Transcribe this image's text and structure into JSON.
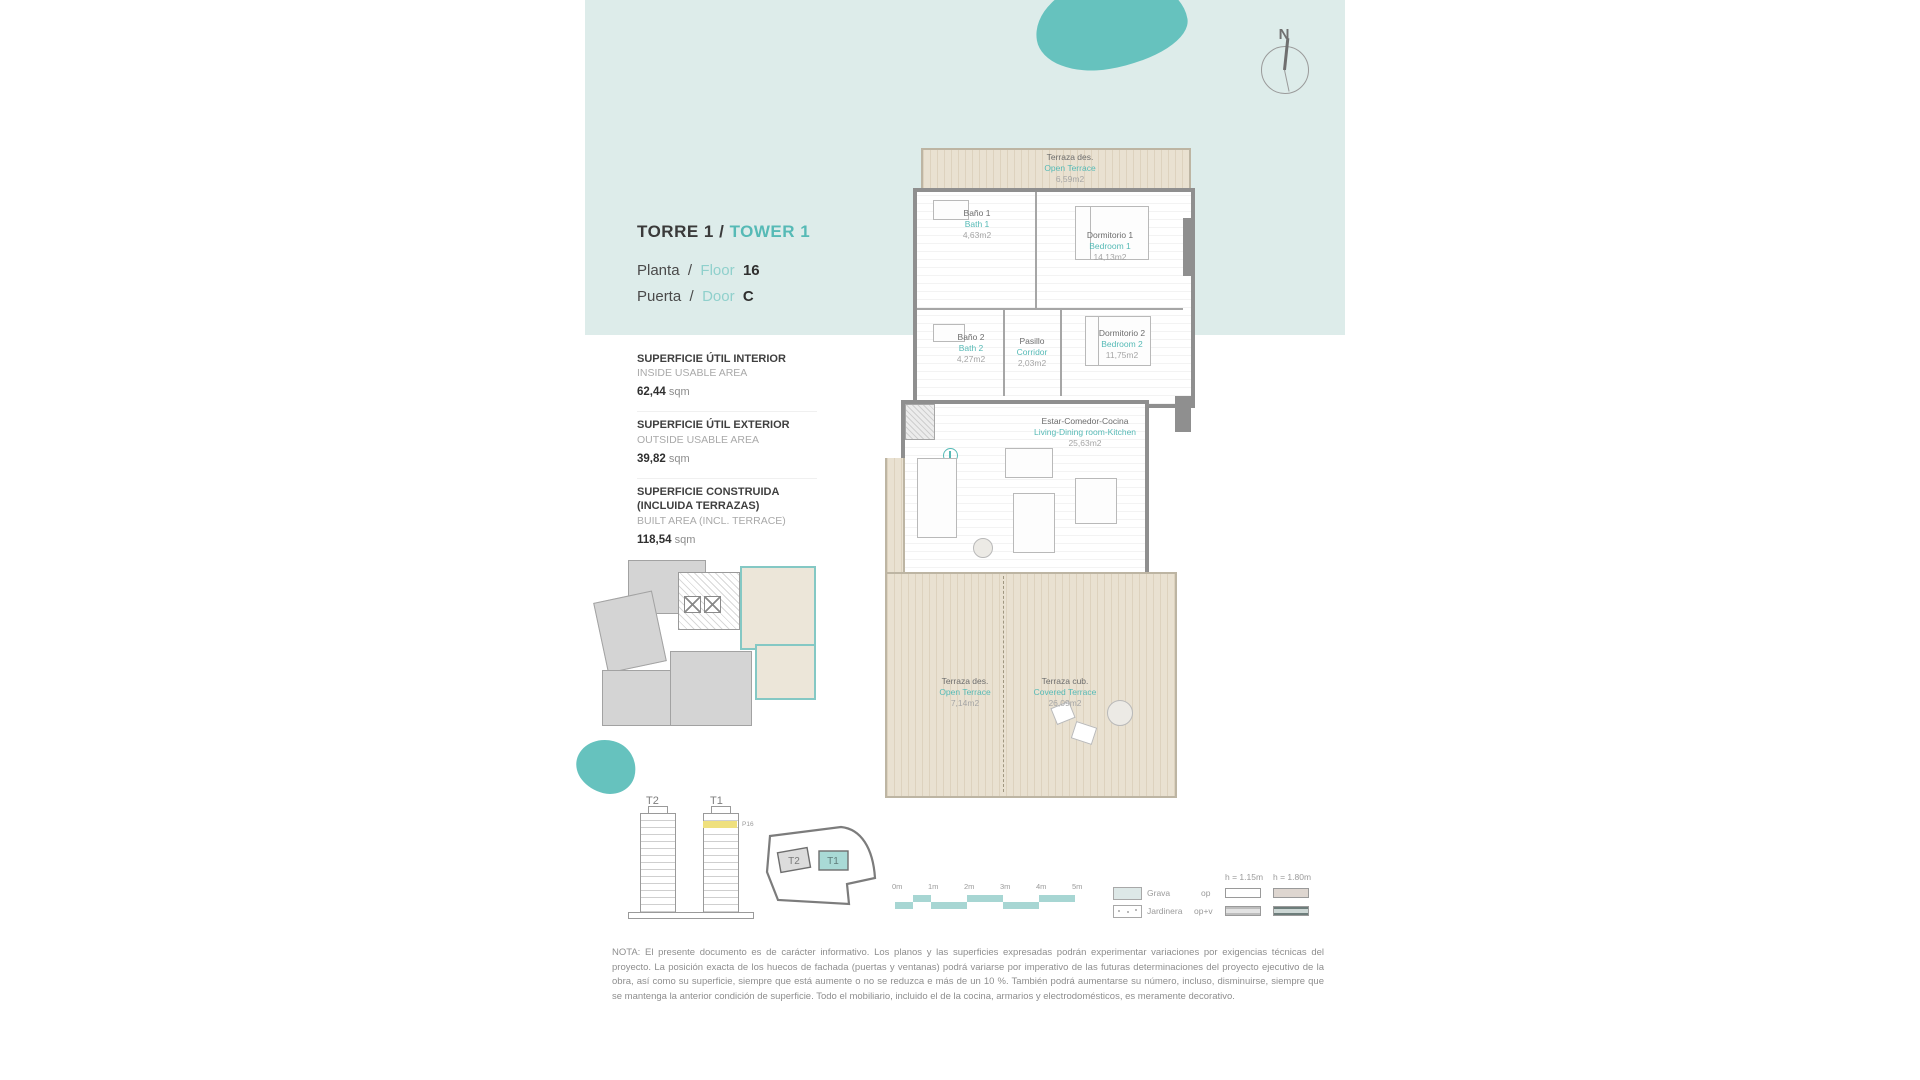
{
  "page": {
    "title_es": "TORRE 1 /",
    "title_en": "TOWER 1",
    "planta_es": "Planta",
    "planta_sep": "/",
    "planta_en": "Floor",
    "planta_value": "16",
    "puerta_es": "Puerta",
    "puerta_sep": "/",
    "puerta_en": "Door",
    "puerta_value": "C"
  },
  "compass": {
    "north": "N"
  },
  "areas": [
    {
      "es": "SUPERFICIE ÚTIL INTERIOR",
      "en": "INSIDE USABLE AREA",
      "value": "62,44",
      "unit": "sqm"
    },
    {
      "es": "SUPERFICIE ÚTIL EXTERIOR",
      "en": "OUTSIDE USABLE AREA",
      "value": "39,82",
      "unit": "sqm"
    },
    {
      "es": "SUPERFICIE CONSTRUIDA (INCLUIDA TERRAZAS)",
      "en": "BUILT AREA (INCL. TERRACE)",
      "value": "118,54",
      "unit": "sqm"
    }
  ],
  "rooms": [
    {
      "es": "Terraza des.",
      "en": "Open Terrace",
      "area": "6,59m2"
    },
    {
      "es": "Baño 1",
      "en": "Bath 1",
      "area": "4,63m2"
    },
    {
      "es": "Dormitorio 1",
      "en": "Bedroom 1",
      "area": "14,13m2"
    },
    {
      "es": "Baño 2",
      "en": "Bath 2",
      "area": "4,27m2"
    },
    {
      "es": "Pasillo",
      "en": "Corridor",
      "area": "2,03m2"
    },
    {
      "es": "Dormitorio 2",
      "en": "Bedroom 2",
      "area": "11,75m2"
    },
    {
      "es": "Estar-Comedor-Cocina",
      "en": "Living-Dining room-Kitchen",
      "area": "25,63m2"
    },
    {
      "es": "Terraza des.",
      "en": "Open Terrace",
      "area": "7,14m2"
    },
    {
      "es": "Terraza cub.",
      "en": "Covered Terrace",
      "area": "26,09m2"
    }
  ],
  "towers": {
    "t2_label": "T2",
    "t1_label": "T1",
    "floor_marker": "P16"
  },
  "site": {
    "t2": "T2",
    "t1": "T1"
  },
  "scalebar": {
    "labels": [
      "0m",
      "1m",
      "2m",
      "3m",
      "4m",
      "5m"
    ]
  },
  "legend": {
    "grava": "Grava",
    "jardinera": "Jardinera",
    "row1": "op",
    "row2": "op+v",
    "col1": "h = 1.15m",
    "col2": "h = 1.80m"
  },
  "colors": {
    "teal_band": "#ddecea",
    "teal_accent": "#56bab6",
    "blob_teal": "#66c2be",
    "terrace_beige": "#e9e1d1",
    "highlight_yellow": "#efe07e"
  },
  "note": "NOTA: El presente documento es de carácter informativo. Los planos y las superficies expresadas podrán experimentar variaciones por exigencias técnicas del proyecto. La posición exacta de los huecos de fachada (puertas y ventanas) podrá variarse por imperativo de las futuras determinaciones del proyecto ejecutivo de la obra, así como su superficie, siempre que está aumente o no se reduzca e más de un 10 %. También podrá aumentarse su número, incluso, disminuirse, siempre que se mantenga la anterior condición de superficie. Todo el mobiliario, incluido el de la cocina, armarios y electrodomésticos, es meramente decorativo."
}
